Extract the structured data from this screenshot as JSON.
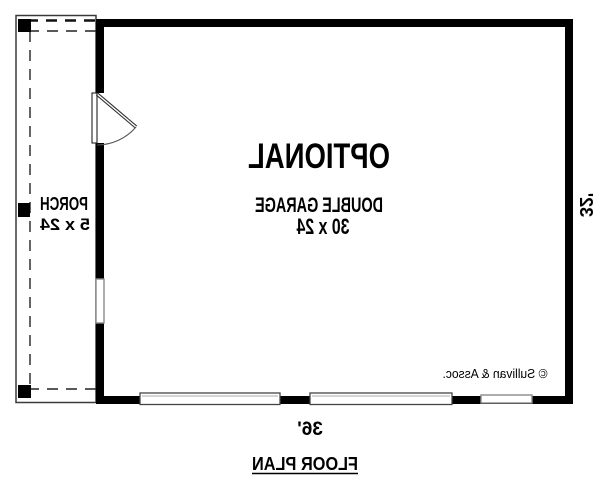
{
  "plan": {
    "room": {
      "line1": "OPTIONAL",
      "line2": "DOUBLE GARAGE",
      "line3": "30 x 24"
    },
    "porch": {
      "line1": "PORCH",
      "line2": "5 x 24"
    },
    "dimensions": {
      "bottom_width": "36'",
      "side_height": "32'"
    },
    "copyright": "© Sullivan & Assoc.",
    "title": "FLOOR PLAN"
  },
  "colors": {
    "wall": "#000000",
    "background": "#ffffff",
    "text": "#000000"
  }
}
